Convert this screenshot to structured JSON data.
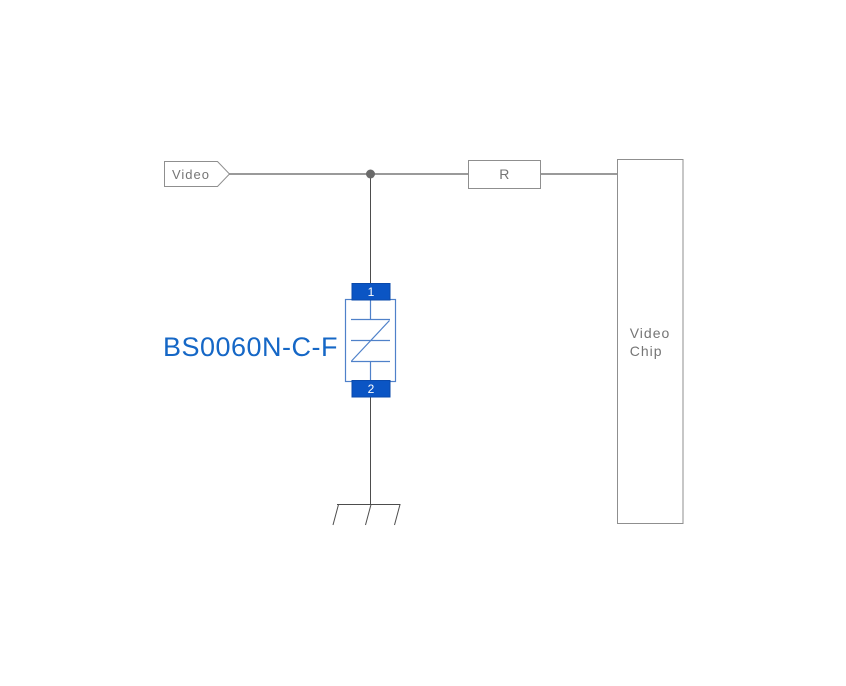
{
  "diagram": {
    "type": "circuit-schematic",
    "port": {
      "label": "Video"
    },
    "resistor": {
      "label": "R"
    },
    "chip": {
      "label_line1": "Video",
      "label_line2": "Chip"
    },
    "protection_component": {
      "label": "BS0060N-C-F",
      "pin_top": "1",
      "pin_bottom": "2"
    },
    "colors": {
      "background": "#ffffff",
      "wire": "#9a9a9a",
      "thin_wire": "#4d4d4d",
      "junction_dot": "#6a6a6a",
      "box_border": "#8f8f8f",
      "text_gray": "#757575",
      "component_fill": "#0b55c4",
      "component_outline": "#4f81c9",
      "component_label": "#1567c6",
      "pin_text": "#ffffff"
    }
  }
}
